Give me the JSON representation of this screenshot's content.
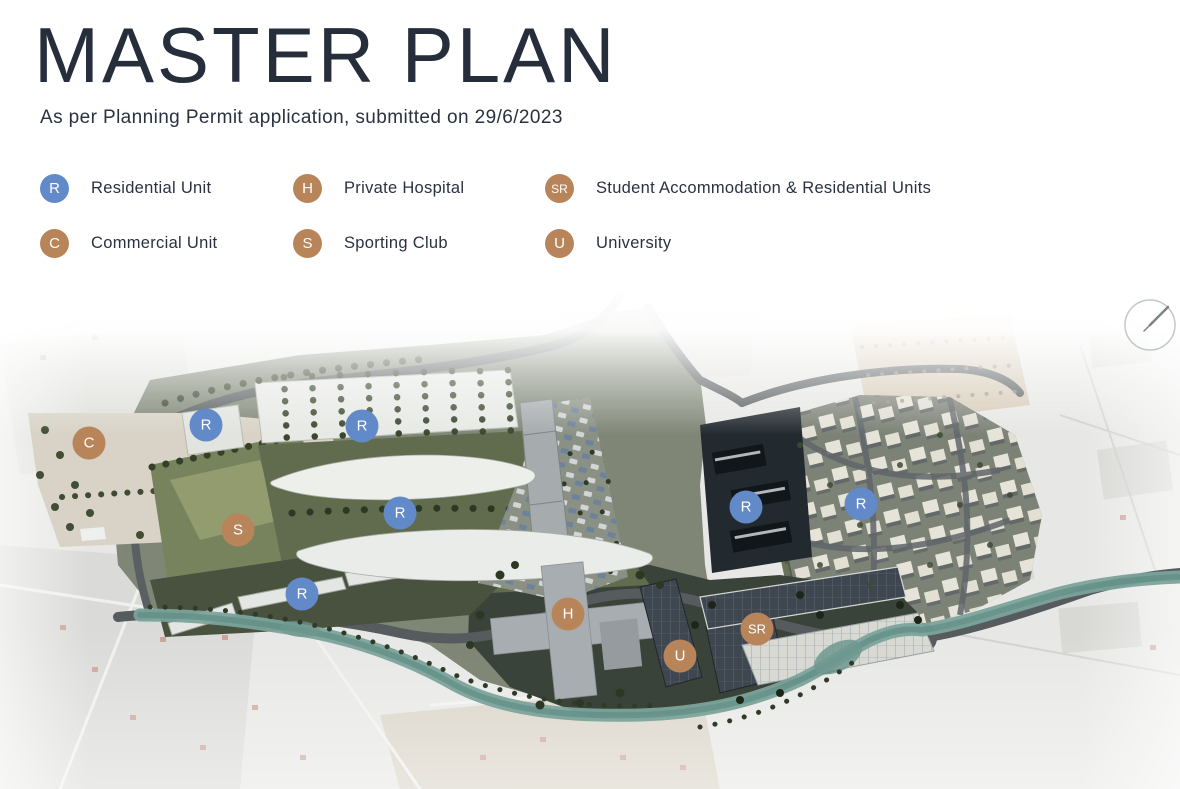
{
  "page": {
    "title": "MASTER PLAN",
    "subtitle": "As per Planning Permit application, submitted on 29/6/2023"
  },
  "colors": {
    "blue": "#6289c8",
    "brown": "#b8855a",
    "text": "#2a3140"
  },
  "legend": {
    "items": [
      {
        "code": "R",
        "label": "Residential Unit",
        "type": "blue"
      },
      {
        "code": "H",
        "label": "Private Hospital",
        "type": "brown"
      },
      {
        "code": "SR",
        "label": "Student Accommodation & Residential Units",
        "type": "brown"
      },
      {
        "code": "C",
        "label": "Commercial Unit",
        "type": "blue-alt",
        "type_fix": "brown",
        "type2": "brown"
      },
      {
        "code": "S",
        "label": "Sporting Club",
        "type": "brown"
      },
      {
        "code": "U",
        "label": "University",
        "type": "brown"
      }
    ]
  },
  "map": {
    "compass_icon": "north-arrow-icon",
    "markers": [
      {
        "code": "C",
        "type": "brown",
        "x": 89,
        "y": 158
      },
      {
        "code": "R",
        "type": "blue",
        "x": 206,
        "y": 140
      },
      {
        "code": "R",
        "type": "blue",
        "x": 362,
        "y": 141
      },
      {
        "code": "R",
        "type": "blue",
        "x": 400,
        "y": 228
      },
      {
        "code": "S",
        "type": "brown",
        "x": 238,
        "y": 245
      },
      {
        "code": "R",
        "type": "blue",
        "x": 302,
        "y": 309
      },
      {
        "code": "H",
        "type": "brown",
        "x": 568,
        "y": 329
      },
      {
        "code": "U",
        "type": "brown",
        "x": 680,
        "y": 371
      },
      {
        "code": "SR",
        "type": "brown",
        "x": 757,
        "y": 344
      },
      {
        "code": "R",
        "type": "blue",
        "x": 746,
        "y": 222
      },
      {
        "code": "R",
        "type": "blue",
        "x": 861,
        "y": 219
      }
    ]
  }
}
